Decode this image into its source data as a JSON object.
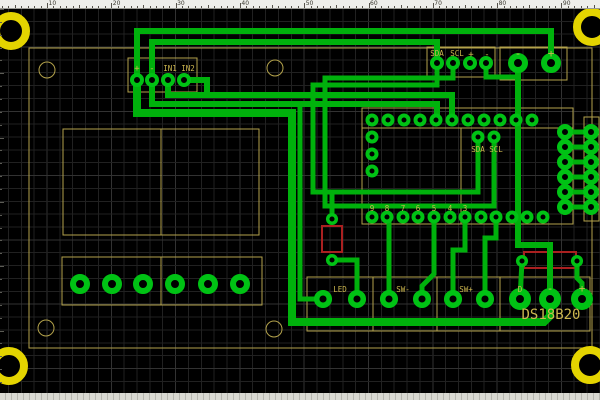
{
  "app": {
    "type": "pcb-layout-editor-canvas"
  },
  "ruler": {
    "unit_px": 6.43,
    "numbers": [
      "10",
      "20",
      "30",
      "40",
      "50",
      "60",
      "70",
      "80",
      "90"
    ],
    "number_start_x": 47,
    "number_step_x": 64.3
  },
  "colors": {
    "background": "#000000",
    "grid_minor": "#212121",
    "grid_major": "#323232",
    "trace": "#00b10c",
    "pad_ring": "#00c214",
    "silk": "#b3a24b",
    "silk_text": "#cdb74f",
    "red_overlay": "#aa2020",
    "mount_hole": "#e4d400",
    "ruler_bg": "#eeeeea"
  },
  "board": {
    "outline": [
      29,
      48,
      563,
      300
    ],
    "silk_rects": [
      {
        "name": "display-outline",
        "r": [
          63,
          129,
          196,
          106
        ]
      },
      {
        "name": "terminal-block-outline",
        "r": [
          62,
          257,
          200,
          48
        ]
      },
      {
        "name": "module-outline",
        "r": [
          362,
          108,
          211,
          116
        ]
      },
      {
        "name": "header-outline",
        "r": [
          584,
          117,
          15,
          104
        ]
      },
      {
        "name": "bottom-connector-outline",
        "r": [
          307,
          277,
          283,
          54
        ]
      },
      {
        "name": "in-connector-outline",
        "r": [
          128,
          58,
          69,
          34
        ]
      },
      {
        "name": "i2c-connector-outline",
        "r": [
          427,
          47,
          68,
          30
        ]
      },
      {
        "name": "power-connector-outline",
        "r": [
          500,
          47,
          67,
          33
        ]
      }
    ],
    "silk_lines": [
      [
        161,
        129,
        161,
        235
      ],
      [
        161,
        257,
        161,
        305
      ],
      [
        362,
        128,
        573,
        128
      ],
      [
        461,
        128,
        461,
        224
      ],
      [
        373,
        277,
        373,
        331
      ],
      [
        437,
        277,
        437,
        331
      ],
      [
        500,
        277,
        500,
        331
      ]
    ],
    "silk_circles": [
      [
        47,
        70
      ],
      [
        275,
        68
      ],
      [
        46,
        328
      ],
      [
        274,
        329
      ]
    ],
    "silk_circle_radius": 8,
    "red_rects": [
      [
        322,
        226,
        20,
        26
      ],
      [
        524,
        252,
        52,
        16
      ]
    ],
    "mounting_holes": [
      [
        11,
        31
      ],
      [
        592,
        27
      ],
      [
        9,
        366
      ],
      [
        590,
        365
      ]
    ],
    "mount_radius": 15,
    "mount_stroke": 8
  },
  "pads": [
    {
      "name": "module-pads",
      "r": 4.5,
      "w": 4,
      "pts": [
        [
          372,
          120
        ],
        [
          388,
          120
        ],
        [
          404,
          120
        ],
        [
          420,
          120
        ],
        [
          436,
          120
        ],
        [
          452,
          120
        ],
        [
          468,
          120
        ],
        [
          484,
          120
        ],
        [
          500,
          120
        ],
        [
          516,
          120
        ],
        [
          532,
          120
        ],
        [
          372,
          137
        ],
        [
          372,
          154
        ],
        [
          372,
          171
        ],
        [
          372,
          217
        ],
        [
          387,
          217
        ],
        [
          403,
          217
        ],
        [
          418,
          217
        ],
        [
          434,
          217
        ],
        [
          450,
          217
        ],
        [
          465,
          217
        ],
        [
          481,
          217
        ],
        [
          496,
          217
        ],
        [
          512,
          217
        ],
        [
          527,
          217
        ],
        [
          543,
          217
        ],
        [
          478,
          137
        ],
        [
          494,
          137
        ]
      ]
    },
    {
      "name": "header-pads",
      "r": 5.5,
      "w": 5,
      "pts": [
        [
          565,
          132
        ],
        [
          591,
          132
        ],
        [
          565,
          147
        ],
        [
          591,
          147
        ],
        [
          565,
          162
        ],
        [
          591,
          162
        ],
        [
          565,
          177
        ],
        [
          591,
          177
        ],
        [
          565,
          192
        ],
        [
          591,
          192
        ],
        [
          565,
          207
        ],
        [
          591,
          207
        ]
      ]
    },
    {
      "name": "in-connector-pads",
      "r": 5,
      "w": 4,
      "pts": [
        [
          137,
          80
        ],
        [
          152,
          80
        ],
        [
          168,
          80
        ],
        [
          184,
          80
        ]
      ]
    },
    {
      "name": "i2c-connector-pads",
      "r": 5,
      "w": 4,
      "pts": [
        [
          437,
          63
        ],
        [
          453,
          63
        ],
        [
          470,
          63
        ],
        [
          486,
          63
        ]
      ]
    },
    {
      "name": "power-connector-pads",
      "r": 7,
      "w": 6,
      "pts": [
        [
          518,
          63
        ],
        [
          551,
          63
        ]
      ]
    },
    {
      "name": "terminal-pads",
      "r": 7,
      "w": 6,
      "pts": [
        [
          80,
          284
        ],
        [
          112,
          284
        ],
        [
          143,
          284
        ],
        [
          175,
          284
        ],
        [
          208,
          284
        ],
        [
          240,
          284
        ]
      ]
    },
    {
      "name": "bottom-connector-pads",
      "r": 6.3,
      "w": 5.5,
      "pts": [
        [
          323,
          299
        ],
        [
          357,
          299
        ],
        [
          389,
          299
        ],
        [
          422,
          299
        ],
        [
          453,
          299
        ],
        [
          485,
          299
        ]
      ]
    },
    {
      "name": "ds18b20-pads",
      "r": 7.5,
      "w": 7,
      "pts": [
        [
          520,
          299
        ],
        [
          550,
          299
        ],
        [
          582,
          299
        ]
      ]
    },
    {
      "name": "resistor-pads",
      "r": 4.3,
      "w": 3.5,
      "pts": [
        [
          332,
          219
        ],
        [
          332,
          260
        ],
        [
          522,
          261
        ],
        [
          577,
          261
        ]
      ]
    }
  ],
  "traces": [
    {
      "w": 6,
      "p": [
        [
          137,
          80
        ],
        [
          137,
          31
        ],
        [
          551,
          31
        ],
        [
          551,
          63
        ]
      ]
    },
    {
      "w": 6,
      "p": [
        [
          152,
          80
        ],
        [
          152,
          42
        ],
        [
          437,
          42
        ],
        [
          437,
          63
        ]
      ]
    },
    {
      "w": 6,
      "p": [
        [
          168,
          80
        ],
        [
          168,
          95
        ],
        [
          452,
          95
        ],
        [
          452,
          120
        ]
      ]
    },
    {
      "w": 6,
      "p": [
        [
          152,
          80
        ],
        [
          152,
          104
        ],
        [
          437,
          104
        ],
        [
          437,
          120
        ]
      ]
    },
    {
      "w": 6,
      "p": [
        [
          184,
          80
        ],
        [
          207,
          80
        ],
        [
          207,
          95
        ]
      ]
    },
    {
      "w": 6,
      "p": [
        [
          518,
          63
        ],
        [
          518,
          245
        ],
        [
          550,
          245
        ],
        [
          550,
          299
        ]
      ]
    },
    {
      "w": 5,
      "p": [
        [
          486,
          63
        ],
        [
          486,
          77
        ],
        [
          518,
          77
        ]
      ]
    },
    {
      "w": 8,
      "p": [
        [
          137,
          80
        ],
        [
          137,
          113
        ],
        [
          292,
          113
        ],
        [
          292,
          322
        ],
        [
          544,
          322
        ],
        [
          550,
          316
        ],
        [
          550,
          299
        ]
      ]
    },
    {
      "w": 5,
      "p": [
        [
          300,
          104
        ],
        [
          300,
          299
        ],
        [
          323,
          299
        ]
      ]
    },
    {
      "w": 5,
      "p": [
        [
          357,
          299
        ],
        [
          357,
          260
        ],
        [
          332,
          260
        ]
      ]
    },
    {
      "w": 5,
      "p": [
        [
          332,
          219
        ],
        [
          332,
          192
        ],
        [
          313,
          192
        ]
      ]
    },
    {
      "w": 5,
      "p": [
        [
          389,
          217
        ],
        [
          389,
          299
        ]
      ]
    },
    {
      "w": 5,
      "p": [
        [
          465,
          217
        ],
        [
          465,
          250
        ],
        [
          453,
          250
        ],
        [
          453,
          299
        ]
      ]
    },
    {
      "w": 5,
      "p": [
        [
          496,
          217
        ],
        [
          496,
          238
        ],
        [
          485,
          238
        ],
        [
          485,
          299
        ]
      ]
    },
    {
      "w": 5,
      "p": [
        [
          522,
          261
        ],
        [
          520,
          299
        ]
      ]
    },
    {
      "w": 5,
      "p": [
        [
          577,
          261
        ],
        [
          577,
          278
        ],
        [
          582,
          283
        ],
        [
          582,
          299
        ]
      ]
    },
    {
      "w": 5,
      "p": [
        [
          437,
          63
        ],
        [
          437,
          85
        ],
        [
          313,
          85
        ],
        [
          313,
          192
        ],
        [
          478,
          192
        ],
        [
          478,
          139
        ]
      ]
    },
    {
      "w": 5,
      "p": [
        [
          453,
          63
        ],
        [
          453,
          78
        ],
        [
          325,
          78
        ],
        [
          325,
          206
        ],
        [
          494,
          206
        ],
        [
          494,
          139
        ]
      ]
    },
    {
      "w": 5,
      "p": [
        [
          422,
          299
        ],
        [
          422,
          286
        ],
        [
          434,
          274
        ],
        [
          434,
          217
        ]
      ]
    },
    {
      "w": 5,
      "p": [
        [
          565,
          132
        ],
        [
          591,
          132
        ]
      ]
    },
    {
      "w": 5,
      "p": [
        [
          565,
          147
        ],
        [
          591,
          147
        ]
      ]
    },
    {
      "w": 5,
      "p": [
        [
          565,
          162
        ],
        [
          591,
          162
        ]
      ]
    },
    {
      "w": 5,
      "p": [
        [
          565,
          177
        ],
        [
          591,
          177
        ]
      ]
    },
    {
      "w": 5,
      "p": [
        [
          565,
          192
        ],
        [
          591,
          192
        ]
      ]
    },
    {
      "w": 5,
      "p": [
        [
          565,
          207
        ],
        [
          591,
          207
        ]
      ]
    }
  ],
  "labels": [
    {
      "t": "+",
      "x": 137,
      "y": 71,
      "s": 9
    },
    {
      "t": "-",
      "x": 152,
      "y": 71,
      "s": 9
    },
    {
      "t": "IN1",
      "x": 170,
      "y": 71,
      "s": 7.5
    },
    {
      "t": "IN2",
      "x": 188,
      "y": 71,
      "s": 7.5
    },
    {
      "t": "SDA",
      "x": 437,
      "y": 56,
      "s": 7.5
    },
    {
      "t": "SCL",
      "x": 457,
      "y": 56,
      "s": 7.5
    },
    {
      "t": "+",
      "x": 471,
      "y": 57,
      "s": 9
    },
    {
      "t": "-",
      "x": 487,
      "y": 57,
      "s": 9
    },
    {
      "t": "-",
      "x": 518,
      "y": 57,
      "s": 11
    },
    {
      "t": "+",
      "x": 551,
      "y": 57,
      "s": 11
    },
    {
      "t": "SDA",
      "x": 478,
      "y": 152,
      "s": 7.5
    },
    {
      "t": "SCL",
      "x": 496,
      "y": 152,
      "s": 7.5
    },
    {
      "t": "9",
      "x": 372,
      "y": 211,
      "s": 7.5
    },
    {
      "t": "8",
      "x": 387,
      "y": 211,
      "s": 7.5
    },
    {
      "t": "7",
      "x": 403,
      "y": 211,
      "s": 7.5
    },
    {
      "t": "6",
      "x": 418,
      "y": 211,
      "s": 7.5
    },
    {
      "t": "5",
      "x": 434,
      "y": 211,
      "s": 7.5
    },
    {
      "t": "4",
      "x": 450,
      "y": 211,
      "s": 7.5
    },
    {
      "t": "3",
      "x": 465,
      "y": 211,
      "s": 7.5
    },
    {
      "t": "LED",
      "x": 340,
      "y": 292,
      "s": 7.5
    },
    {
      "t": "SW-",
      "x": 403,
      "y": 292,
      "s": 7.5
    },
    {
      "t": "SW+",
      "x": 466,
      "y": 292,
      "s": 7.5
    },
    {
      "t": "D",
      "x": 520,
      "y": 292,
      "s": 7.5
    },
    {
      "t": "-",
      "x": 550,
      "y": 292,
      "s": 11
    },
    {
      "t": "+",
      "x": 582,
      "y": 292,
      "s": 11
    },
    {
      "t": "DS18B20",
      "x": 551,
      "y": 319,
      "s": 14
    }
  ]
}
